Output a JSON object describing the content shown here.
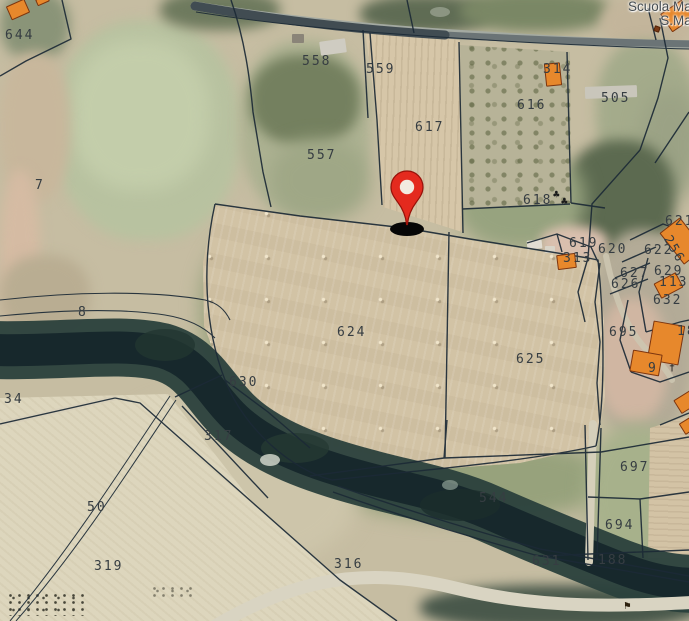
{
  "map": {
    "place_label": {
      "line1": "Scuola Mate",
      "line2": "S.Marti"
    },
    "marker": {
      "type": "red-location-pin"
    },
    "parcels": [
      {
        "id": "644",
        "x": 5,
        "y": 28
      },
      {
        "id": "558",
        "x": 302,
        "y": 54
      },
      {
        "id": "559",
        "x": 366,
        "y": 62
      },
      {
        "id": "617",
        "x": 415,
        "y": 120
      },
      {
        "id": "314",
        "x": 543,
        "y": 62
      },
      {
        "id": "616",
        "x": 517,
        "y": 98
      },
      {
        "id": "505",
        "x": 601,
        "y": 91
      },
      {
        "id": "557",
        "x": 307,
        "y": 148
      },
      {
        "id": "7",
        "x": 35,
        "y": 178
      },
      {
        "id": "618",
        "x": 523,
        "y": 193
      },
      {
        "id": "619",
        "x": 569,
        "y": 236
      },
      {
        "id": "620",
        "x": 598,
        "y": 242
      },
      {
        "id": "621",
        "x": 665,
        "y": 214
      },
      {
        "id": "622",
        "x": 644,
        "y": 243
      },
      {
        "id": "256",
        "x": 673,
        "y": 233,
        "rot": 60
      },
      {
        "id": "313",
        "x": 563,
        "y": 251
      },
      {
        "id": "627",
        "x": 620,
        "y": 266
      },
      {
        "id": "629",
        "x": 654,
        "y": 264
      },
      {
        "id": "626",
        "x": 611,
        "y": 277
      },
      {
        "id": "1136",
        "x": 659,
        "y": 275
      },
      {
        "id": "632",
        "x": 653,
        "y": 293
      },
      {
        "id": "695",
        "x": 609,
        "y": 325
      },
      {
        "id": "9",
        "x": 648,
        "y": 361
      },
      {
        "id": "18",
        "x": 677,
        "y": 324
      },
      {
        "id": "8",
        "x": 78,
        "y": 305
      },
      {
        "id": "624",
        "x": 337,
        "y": 325
      },
      {
        "id": "625",
        "x": 516,
        "y": 352
      },
      {
        "id": "630",
        "x": 229,
        "y": 375
      },
      {
        "id": "317",
        "x": 204,
        "y": 429
      },
      {
        "id": "34",
        "x": 4,
        "y": 392
      },
      {
        "id": "50",
        "x": 87,
        "y": 500
      },
      {
        "id": "319",
        "x": 94,
        "y": 559
      },
      {
        "id": "316",
        "x": 334,
        "y": 557
      },
      {
        "id": "544",
        "x": 479,
        "y": 491
      },
      {
        "id": "697",
        "x": 620,
        "y": 460
      },
      {
        "id": "694",
        "x": 605,
        "y": 518
      },
      {
        "id": "631",
        "x": 532,
        "y": 554
      },
      {
        "id": "188",
        "x": 598,
        "y": 553
      }
    ]
  },
  "icons": {
    "tree": "♣",
    "cross": "†",
    "flag": "⚑"
  },
  "colors": {
    "pin_red": "#e42a1e",
    "pin_outline": "#971109",
    "building_fill": "#e7882c",
    "building_stroke": "#7d350e",
    "boundary_line": "#1c2a36",
    "river_dark": "#17282c",
    "label_text": "#363d42"
  }
}
